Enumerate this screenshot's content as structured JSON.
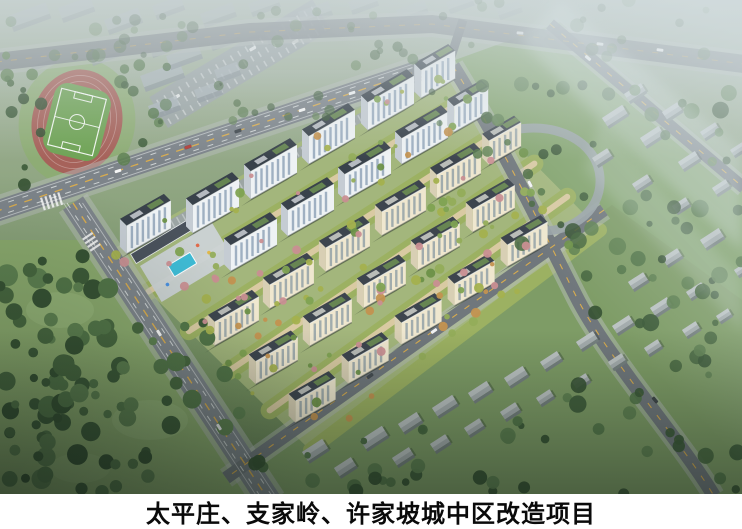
{
  "caption": {
    "text": "太平庄、支家岭、许家坡城中区改造项目"
  },
  "palette": {
    "caption_bg": "#ffffff",
    "caption_fg": "#0a0a0a",
    "park_lawn": "#8aa96d",
    "east_lawn": "#82a36b",
    "village_lawn": "#7e9c66",
    "dev_base": "#a3b67c",
    "band": "#9cb162",
    "path_tan": "#d9caa2",
    "sidewalk": "#b5bbb9",
    "road": "#70777c",
    "road_main": "#7d848a",
    "lane_yellow": "#d9ac4e",
    "lane_white": "#e9edec",
    "track": "#a6625a",
    "pitch": "#6fa355",
    "plaza": "#ccd3d6",
    "pool": "#3fbcd6",
    "commercial_roof": "#4a525c",
    "curved_wall": "#9aa4a8",
    "parking": "#9ba3a8",
    "context_roof": "#aab4b9",
    "context_side": "#8c969c",
    "village_roof": "#a3abac",
    "village_roof_light": "#bcc3c3",
    "village_side": "#75807f",
    "village_shadow": "rgba(35,48,40,0.32)",
    "tower_shadow": "rgba(30,40,34,0.32)",
    "haze": "#d2dbde",
    "fog": "#d8e2e6",
    "tree_dark": [
      "#3c5a38",
      "#47673f",
      "#527548",
      "#5d8050",
      "#365233"
    ],
    "tree_mixed": [
      "#6d9148",
      "#7fa352",
      "#93ad5a",
      "#c39250",
      "#c98f92",
      "#a4b14e"
    ]
  },
  "scene": {
    "dev_quad": [
      [
        108,
        252
      ],
      [
        436,
        64
      ],
      [
        600,
        230
      ],
      [
        310,
        450
      ]
    ],
    "towers": {
      "styles": [
        {
          "h": 28,
          "facade": "#eef2f4",
          "win": "#96a9bc",
          "side": "#c5ccd3",
          "roof": "#39424b",
          "panel": "#c3c8cd",
          "roofgreen": "#6e9054"
        },
        {
          "h": 26,
          "facade": "#eef2f4",
          "win": "#96a9bc",
          "side": "#c5ccd3",
          "roof": "#39424b",
          "panel": "#c3c8cd",
          "roofgreen": "#6e9054"
        },
        {
          "h": 24,
          "facade": "#efe7cf",
          "win": "#98a5a8",
          "side": "#d8cfb4",
          "roof": "#3d454e",
          "panel": "#c6c9c4",
          "roofgreen": "#6e9054"
        },
        {
          "h": 23,
          "facade": "#efe7cf",
          "win": "#98a5a8",
          "side": "#d8cfb4",
          "roof": "#3d454e",
          "panel": "#c6c9c4",
          "roofgreen": "#6e9054"
        },
        {
          "h": 22,
          "facade": "#efe7cf",
          "win": "#98a5a8",
          "side": "#d8cfb4",
          "roof": "#3d454e",
          "panel": "#c6c9c4",
          "roofgreen": "#6e9054"
        }
      ],
      "items": [
        [
          146,
          243,
          44,
          0
        ],
        [
          213,
          222,
          46,
          0
        ],
        [
          271,
          188,
          46,
          0
        ],
        [
          329,
          153,
          46,
          0
        ],
        [
          388,
          119,
          46,
          0
        ],
        [
          436,
          90,
          34,
          0
        ],
        [
          251,
          260,
          46,
          1
        ],
        [
          308,
          225,
          46,
          1
        ],
        [
          365,
          189,
          46,
          1
        ],
        [
          422,
          153,
          46,
          1
        ],
        [
          469,
          124,
          34,
          1
        ],
        [
          234,
          335,
          44,
          2
        ],
        [
          289,
          298,
          44,
          2
        ],
        [
          345,
          261,
          44,
          2
        ],
        [
          401,
          225,
          44,
          2
        ],
        [
          456,
          188,
          44,
          2
        ],
        [
          503,
          157,
          32,
          2
        ],
        [
          274,
          374,
          42,
          3
        ],
        [
          328,
          336,
          42,
          3
        ],
        [
          382,
          298,
          42,
          3
        ],
        [
          436,
          260,
          42,
          3
        ],
        [
          491,
          222,
          42,
          3
        ],
        [
          313,
          413,
          40,
          4
        ],
        [
          366,
          374,
          40,
          4
        ],
        [
          419,
          335,
          40,
          4
        ],
        [
          472,
          296,
          40,
          4
        ],
        [
          525,
          257,
          40,
          4
        ]
      ]
    },
    "village_buildings": [
      [
        302,
        452,
        24,
        11
      ],
      [
        334,
        468,
        20,
        10
      ],
      [
        360,
        440,
        26,
        11
      ],
      [
        392,
        458,
        20,
        9
      ],
      [
        398,
        424,
        22,
        10
      ],
      [
        430,
        444,
        18,
        9
      ],
      [
        432,
        408,
        24,
        10
      ],
      [
        464,
        428,
        18,
        9
      ],
      [
        468,
        393,
        22,
        10
      ],
      [
        500,
        412,
        18,
        9
      ],
      [
        504,
        378,
        22,
        10
      ],
      [
        536,
        398,
        16,
        8
      ],
      [
        540,
        362,
        20,
        9
      ],
      [
        572,
        382,
        16,
        8
      ],
      [
        576,
        342,
        20,
        9
      ],
      [
        608,
        362,
        16,
        8
      ],
      [
        612,
        326,
        20,
        9
      ],
      [
        644,
        348,
        16,
        8
      ],
      [
        650,
        308,
        20,
        9
      ],
      [
        682,
        330,
        16,
        8
      ],
      [
        686,
        292,
        18,
        8
      ],
      [
        716,
        316,
        14,
        7
      ],
      [
        700,
        240,
        22,
        10
      ],
      [
        662,
        258,
        18,
        9
      ],
      [
        628,
        282,
        18,
        9
      ],
      [
        734,
        270,
        12,
        7
      ],
      [
        602,
        118,
        24,
        10
      ],
      [
        640,
        138,
        22,
        10
      ],
      [
        678,
        162,
        20,
        9
      ],
      [
        624,
        94,
        20,
        9
      ],
      [
        662,
        112,
        18,
        9
      ],
      [
        700,
        132,
        18,
        8
      ],
      [
        592,
        158,
        18,
        9
      ],
      [
        632,
        184,
        18,
        8
      ],
      [
        672,
        206,
        16,
        8
      ],
      [
        712,
        188,
        16,
        8
      ],
      [
        730,
        150,
        14,
        7
      ]
    ],
    "context_buildings": [
      [
        8,
        16,
        40,
        12,
        0.6
      ],
      [
        58,
        8,
        34,
        11,
        0.6
      ],
      [
        104,
        20,
        36,
        11,
        0.6
      ],
      [
        152,
        6,
        30,
        10,
        0.55
      ],
      [
        200,
        14,
        34,
        10,
        0.55
      ],
      [
        248,
        4,
        30,
        9,
        0.5
      ],
      [
        298,
        12,
        32,
        10,
        0.5
      ],
      [
        348,
        2,
        28,
        9,
        0.5
      ],
      [
        396,
        10,
        30,
        9,
        0.45
      ],
      [
        446,
        2,
        26,
        8,
        0.45
      ],
      [
        496,
        8,
        24,
        8,
        0.4
      ],
      [
        28,
        58,
        26,
        9,
        0.7
      ],
      [
        88,
        52,
        30,
        10,
        0.7
      ],
      [
        148,
        44,
        34,
        10,
        0.65
      ],
      [
        208,
        38,
        30,
        9,
        0.6
      ],
      [
        264,
        32,
        28,
        9,
        0.55
      ],
      [
        140,
        76,
        42,
        12,
        0.85
      ],
      [
        166,
        56,
        34,
        10,
        0.8
      ],
      [
        148,
        106,
        30,
        10,
        0.85
      ],
      [
        194,
        90,
        26,
        9,
        0.8
      ],
      [
        214,
        70,
        24,
        9,
        0.75
      ]
    ],
    "tree_regions": [
      {
        "b": [
          0,
          255,
          110,
          494
        ],
        "n": 70,
        "r": [
          4,
          11
        ],
        "pal": "tree_dark",
        "op": 1,
        "seed": 11
      },
      {
        "b": [
          95,
          320,
          240,
          494
        ],
        "n": 30,
        "r": [
          4,
          10
        ],
        "pal": "tree_dark",
        "op": 1,
        "seed": 22
      },
      {
        "b": [
          240,
          420,
          560,
          494
        ],
        "n": 26,
        "r": [
          3,
          8
        ],
        "pal": "tree_dark",
        "op": 0.95,
        "seed": 33
      },
      {
        "b": [
          560,
          240,
          742,
          494
        ],
        "n": 38,
        "r": [
          3,
          9
        ],
        "pal": "tree_dark",
        "op": 0.9,
        "seed": 44
      },
      {
        "b": [
          470,
          80,
          742,
          250
        ],
        "n": 44,
        "r": [
          3,
          9
        ],
        "pal": "tree_dark",
        "op": 0.85,
        "seed": 55
      },
      {
        "b": [
          0,
          55,
          42,
          185
        ],
        "n": 12,
        "r": [
          3,
          8
        ],
        "pal": "tree_dark",
        "op": 0.9,
        "seed": 66
      },
      {
        "b": [
          118,
          60,
          168,
          180
        ],
        "n": 10,
        "r": [
          3,
          7
        ],
        "pal": "tree_dark",
        "op": 0.85,
        "seed": 77
      },
      {
        "b": [
          0,
          0,
          742,
          58
        ],
        "n": 44,
        "r": [
          3,
          7
        ],
        "pal": "tree_dark",
        "op": 0.5,
        "seed": 88
      },
      {
        "b": [
          160,
          40,
          440,
          140
        ],
        "n": 20,
        "r": [
          2.5,
          6
        ],
        "pal": "tree_dark",
        "op": 0.65,
        "seed": 99
      }
    ],
    "dev_trees": {
      "count": 130,
      "r": [
        2,
        5
      ],
      "seed": 7
    },
    "cars": [
      [
        118,
        171,
        -18,
        "#f5f6f6"
      ],
      [
        238,
        131,
        -18,
        "#3e464c"
      ],
      [
        352,
        93,
        -18,
        "#f2f4f4"
      ],
      [
        188,
        147,
        -18,
        "#b4403a"
      ],
      [
        302,
        110,
        -18,
        "#f5f6f6"
      ],
      [
        159,
        333,
        57,
        "#f5f6f6"
      ],
      [
        219,
        427,
        57,
        "#e8eaea"
      ],
      [
        434,
        331,
        -35,
        "#f2f3f3"
      ],
      [
        370,
        376,
        -35,
        "#454c52"
      ],
      [
        530,
        184,
        62,
        "#f4f5f5"
      ],
      [
        655,
        400,
        50,
        "#3f464a"
      ],
      [
        600,
        44,
        7,
        "#f4f5f5"
      ],
      [
        660,
        50,
        7,
        "#ffffff"
      ],
      [
        520,
        33,
        4,
        "#e8e8e8"
      ],
      [
        588,
        58,
        40,
        "#ffffff"
      ]
    ]
  }
}
